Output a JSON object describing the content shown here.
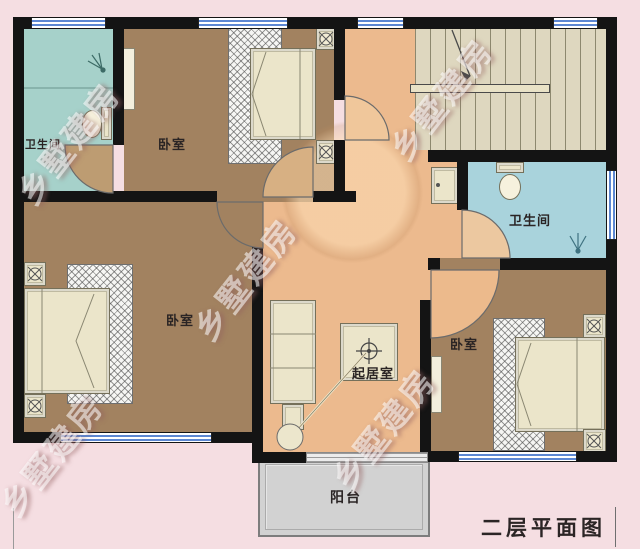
{
  "title": "二层平面图",
  "watermark": "乡墅建房",
  "labels": {
    "bathroom_top_left": "卫生间",
    "bedroom_top": "卧室",
    "bathroom_right": "卫生间",
    "bedroom_bottom_left": "卧室",
    "living_room": "起居室",
    "bedroom_bottom_right": "卧室",
    "balcony": "阳台"
  },
  "colors": {
    "bg": "#f5dee2",
    "wall": "#141414",
    "bedroom": "#a28260",
    "hall": "#ecba8e",
    "bathL": "#a6d1ca",
    "bathR": "#a9d3dc",
    "stairs": "#ded7bf",
    "cream": "#ebe5ca",
    "balcony": "#d2d2d2",
    "winblue": "#5d87d2",
    "label": "#2a2424"
  }
}
